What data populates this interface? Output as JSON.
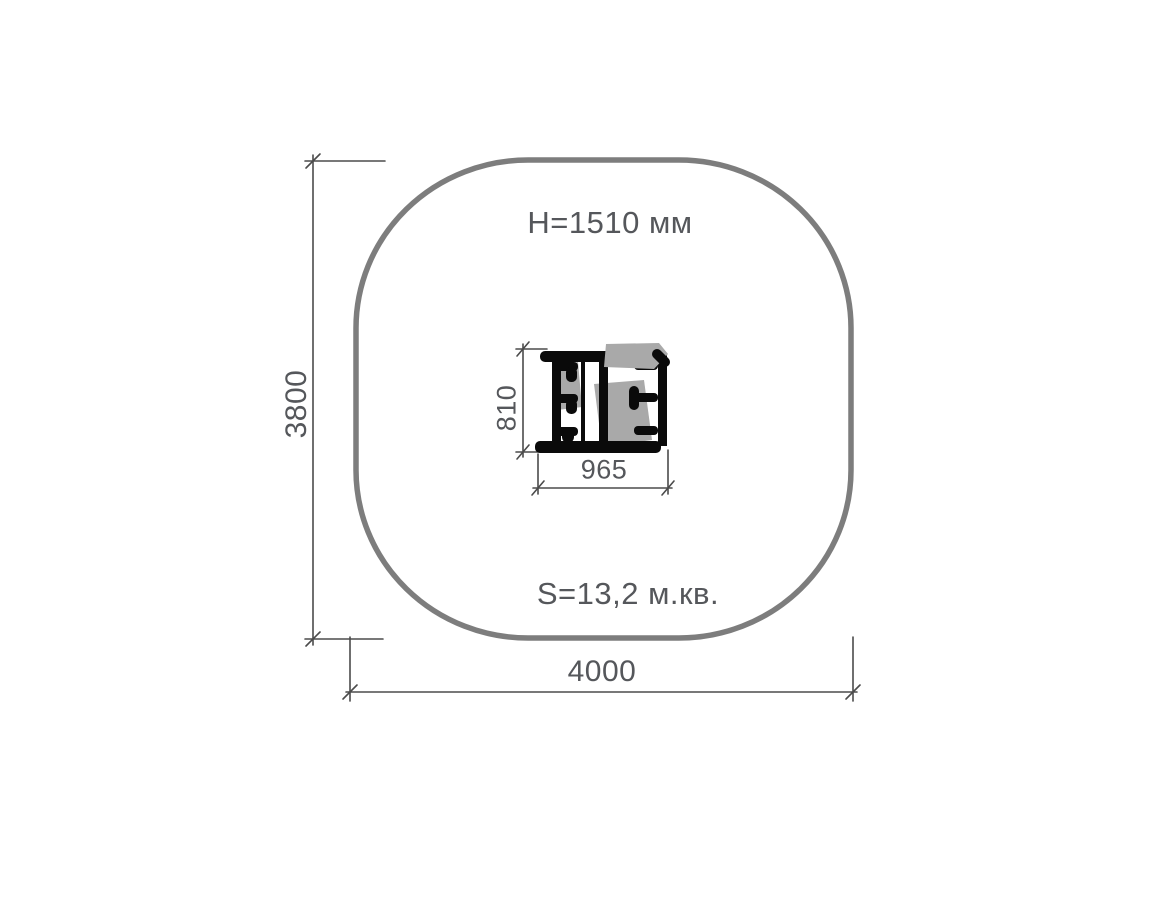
{
  "diagram": {
    "type": "equipment-plan-view",
    "annotations": {
      "height_label": "H=1510 мм",
      "area_label": "S=13,2 м.кв."
    },
    "dimensions": {
      "site_depth": "3800",
      "site_width": "4000",
      "equipment_depth": "810",
      "equipment_width": "965"
    },
    "colors": {
      "background": "#ffffff",
      "outline": "#7d7d7d",
      "dimension-line": "#4b4b4b",
      "text": "#55575b",
      "equipment": "#0a0a0a",
      "watermark": "#a9a9a9"
    }
  }
}
